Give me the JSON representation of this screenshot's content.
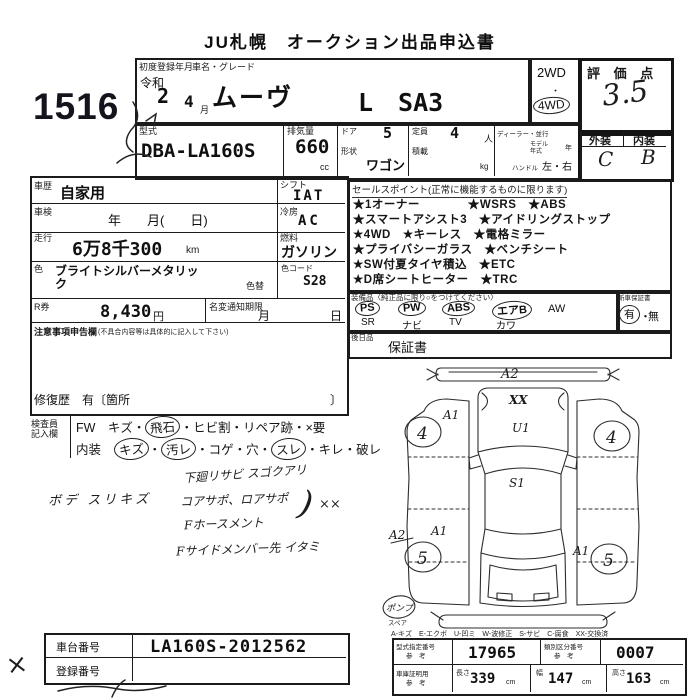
{
  "title": "JU札幌　オークション出品申込書",
  "lot_number": "1516",
  "reg": {
    "label": "初度登録年月",
    "era": "令和",
    "year": "2",
    "month": "4",
    "month_unit": "月"
  },
  "name": {
    "label": "車名・グレード",
    "car": "ムーヴ",
    "grade": "L　SA3"
  },
  "drive": {
    "d2": "2WD",
    "dot": "・",
    "d4": "4WD"
  },
  "score": {
    "label": "評 価 点",
    "value": "3.5",
    "ext_label": "外装",
    "int_label": "内装",
    "ext": "C",
    "int": "B"
  },
  "spec": {
    "model_label": "型式",
    "model": "DBA-LA160S",
    "disp_label": "排気量",
    "disp": "660",
    "disp_unit": "cc",
    "door_label": "ドア",
    "door": "5",
    "shape_label": "形状",
    "shape": "ワゴン",
    "cap_label": "定員",
    "cap": "4",
    "cap_unit": "人",
    "load_label": "積載",
    "load_unit": "kg",
    "dealer_label": "ディーラー・並行",
    "my_label1": "モデル",
    "my_label2": "年式",
    "my_unit": "年",
    "handle_label": "ハンドル",
    "handle": "左・右"
  },
  "left": {
    "history_label": "車歴",
    "history": "自家用",
    "shift_label": "シフト",
    "shift": "IAT",
    "shaken_label": "車検",
    "shaken": "年　　月(　　日)",
    "ac_label": "冷房",
    "ac": "AC",
    "run_label": "走行",
    "run": "6万8千300",
    "run_unit": "km",
    "fuel_label": "燃料",
    "fuel": "ガソリン",
    "color_label": "色",
    "color": "ブライトシルバーメタリック",
    "color_change": "色替",
    "code_label": "色コード",
    "code": "S28",
    "r_label": "R券",
    "r_value": "8,430",
    "yen": "円",
    "meihen_label": "名変通知期限",
    "meihen_month": "月",
    "meihen_day": "日",
    "notes_label": "注意事項申告欄",
    "notes_hint": "(不具合内容等は具体的に記入して下さい)",
    "repair": "修復歴　有〔箇所",
    "repair_close": "〕"
  },
  "sales": {
    "header": "セールスポイント(正常に機能するものに限ります)",
    "lines": [
      "★1オーナー　　　　★WSRS　★ABS",
      "★スマートアシスト3　★アイドリングストップ",
      "★4WD　★キーレス　★電格ミラー",
      "★プライバシーガラス　★ベンチシート",
      "★SW付夏タイヤ積込　★ETC",
      "★D席シートヒーター　★TRC"
    ]
  },
  "equip": {
    "header": "装備品〈純正品に限り○をつけてください〉",
    "row1": [
      "PS",
      "PW",
      "ABS",
      "エアB",
      "AW"
    ],
    "row2": [
      "SR",
      "ナビ",
      "TV",
      "カワ"
    ],
    "warranty_label": "新車保証書",
    "yes": "有",
    "sep": "・",
    "no": "無",
    "later_label": "後日品",
    "later": "保証書"
  },
  "inspector": {
    "label1": "検査員",
    "label2": "記入欄",
    "fw": [
      {
        "t": "FW　キズ・"
      },
      {
        "t": "飛石"
      },
      {
        "t": "・ヒビ割・リペア跡・×要"
      }
    ],
    "interior": [
      {
        "t": "内装　"
      },
      {
        "t": "キズ"
      },
      {
        "t": "・"
      },
      {
        "t": "汚レ"
      },
      {
        "t": "・コゲ・穴・"
      },
      {
        "t": "スレ"
      },
      {
        "t": "・キレ・破レ"
      }
    ]
  },
  "hand": {
    "body": "ボデ スリキズ",
    "n1": "下廻リサビ スゴクアリ",
    "n2": "コアサポ、ロアサポ",
    "n3": "Fホースメント",
    "n4": "Fサイドメンバー先 イタミ",
    "paren": ")",
    "xx": "××",
    "cross": "×"
  },
  "diagram": {
    "a2_top": "A2",
    "xx": "XX",
    "a1_front": "A1",
    "u1": "U1",
    "s1": "S1",
    "a2_rear": "A2",
    "a1_rear_left": "A1",
    "a1_rear_right": "A1",
    "wheel_fl": "4",
    "wheel_fr": "4",
    "wheel_rl": "5",
    "wheel_rr": "5",
    "spare_note": "ポンプ",
    "spare_label": "スペア",
    "legend": "A-キズ　E-エクボ　U-凹ミ　W-波修正　S-サビ　C-腐食　XX-交換済"
  },
  "bottom": {
    "chassis_label": "車台番号",
    "chassis": "LA160S-2012562",
    "regno_label": "登録番号",
    "type_label": "型式指定番号",
    "ref": "参　考",
    "type_no": "17965",
    "class_label": "類別区分番号",
    "class_no": "0007",
    "garage_label": "車庫証明用",
    "len_label": "長さ",
    "len": "339",
    "cm": "cm",
    "wid_label": "幅",
    "wid": "147",
    "hei_label": "高さ",
    "hei": "163"
  }
}
